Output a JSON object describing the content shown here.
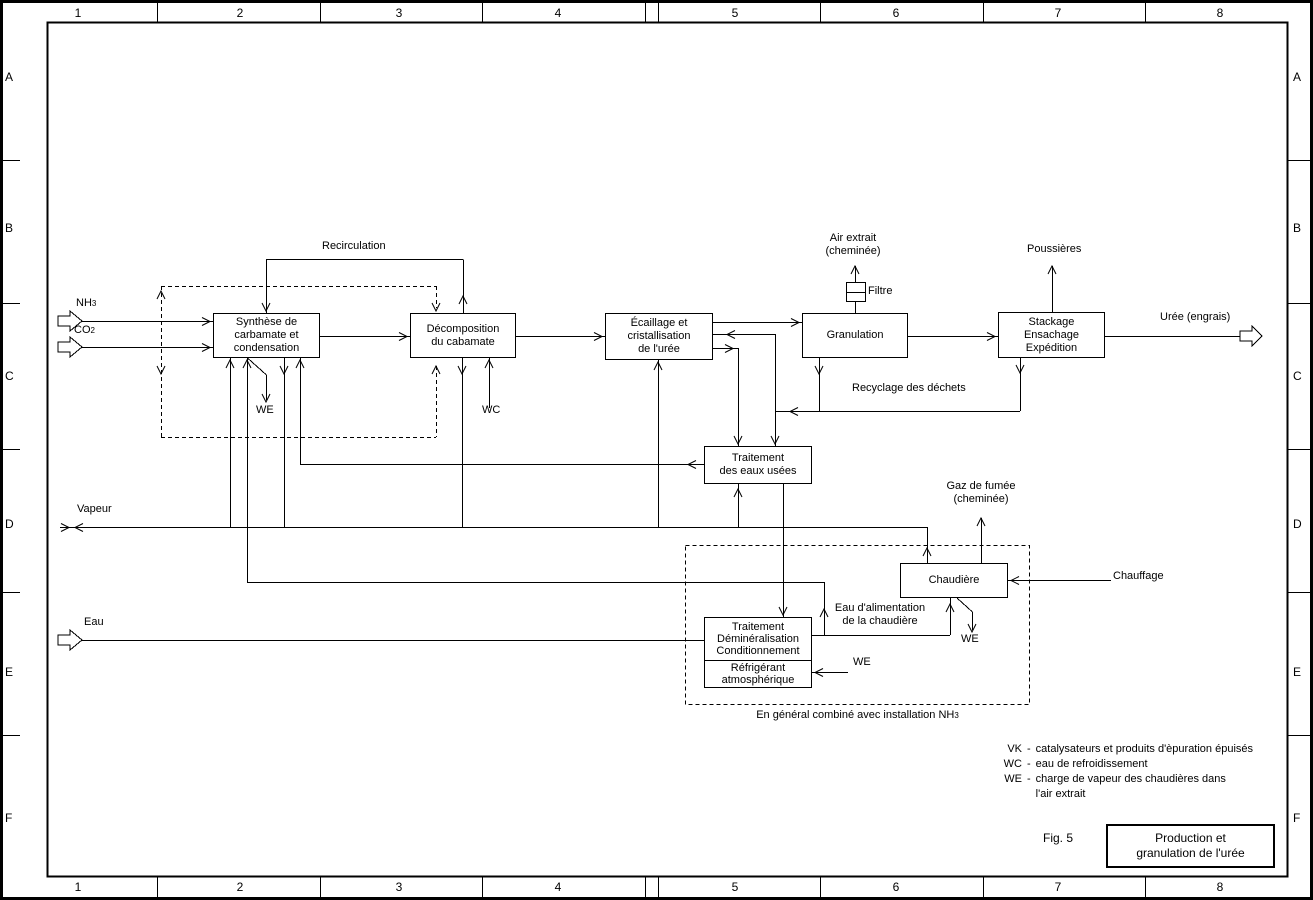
{
  "frame": {
    "columns": [
      "1",
      "2",
      "3",
      "4",
      "5",
      "6",
      "7",
      "8"
    ],
    "rows": [
      "A",
      "B",
      "C",
      "D",
      "E",
      "F"
    ]
  },
  "nodes": {
    "synthese": {
      "label": "Synthèse de\ncarbamate et\ncondensation"
    },
    "decomposition": {
      "label": "Décomposition\ndu cabamate"
    },
    "ecaillage": {
      "label": "Écaillage et\ncristallisation\nde l'urée"
    },
    "granulation": {
      "label": "Granulation"
    },
    "stackage": {
      "label": "Stackage\nEnsachage\nExpédition"
    },
    "eaux_usees": {
      "label": "Traitement\ndes eaux usées"
    },
    "chaudiere": {
      "label": "Chaudière"
    },
    "demineralisation": {
      "label": "Traitement\nDéminéralisation\nConditionnement"
    },
    "refrigerant": {
      "label": "Réfrigérant\natmosphérique"
    }
  },
  "labels": {
    "nh_base": "NH",
    "nh_sub": "3",
    "co_base": "CO",
    "co_sub": "2",
    "recirculation": "Recirculation",
    "we": "WE",
    "wc": "WC",
    "air_extrait": "Air extrait\n(cheminée)",
    "filtre": "Filtre",
    "poussieres": "Poussières",
    "uree_engrais": "Urée (engrais)",
    "recyclage": "Recyclage des déchets",
    "vapeur": "Vapeur",
    "eau": "Eau",
    "gaz_fumee": "Gaz de fumée\n(cheminée)",
    "chauffage": "Chauffage",
    "eau_alimentation": "Eau d'alimentation\nde la chaudière",
    "en_general_base": "En général combiné avec installation NH",
    "en_general_sub": "3"
  },
  "legend": {
    "separator": "-",
    "items": [
      {
        "code": "VK",
        "desc": "catalysateurs et produits d'èpuration épuisés"
      },
      {
        "code": "WC",
        "desc": "eau de refroidissement"
      },
      {
        "code": "WE",
        "desc": "charge de vapeur des chaudières dans\nl'air extrait"
      }
    ]
  },
  "figure": {
    "fig_label": "Fig. 5",
    "title": "Production et\ngranulation de l'urée"
  }
}
